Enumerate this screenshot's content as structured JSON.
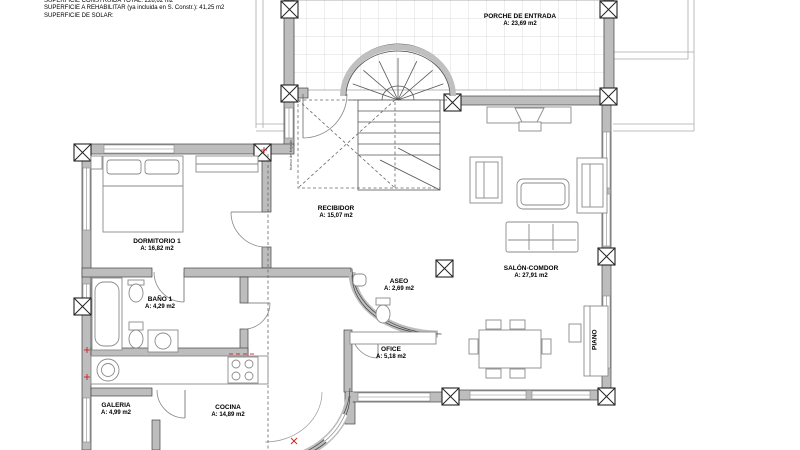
{
  "header": {
    "line1": "SUPERFICIE CONSTRUIDA TOTAL: 228,62 m2",
    "line2": "SUPERFICIE A REHABILITAR (ya incluida en S. Constr.): 41,25 m2",
    "line3": "SUPERFICIE DE SOLAR:"
  },
  "rooms": [
    {
      "id": "porche",
      "name": "PORCHE DE ENTRADA",
      "area": "A: 23,69 m2"
    },
    {
      "id": "recibidor",
      "name": "RECIBIDOR",
      "area": "A: 15,07 m2"
    },
    {
      "id": "dormitorio1",
      "name": "DORMITORIO 1",
      "area": "A: 16,82 m2"
    },
    {
      "id": "bano1",
      "name": "BAÑO 1",
      "area": "A: 4,29 m2"
    },
    {
      "id": "aseo",
      "name": "ASEO",
      "area": "A: 2,69 m2"
    },
    {
      "id": "salon",
      "name": "SALÓN-COMDOR",
      "area": "A: 27,91 m2"
    },
    {
      "id": "ofice",
      "name": "OFICE",
      "area": "A: 5,18 m2"
    },
    {
      "id": "galeria",
      "name": "GALERIA",
      "area": "A: 4,99 m2"
    },
    {
      "id": "cocina",
      "name": "COCINA",
      "area": "A: 14,89 m2"
    }
  ],
  "labels": {
    "piano": "PIANO",
    "stair_void": "hueco de forjado"
  },
  "colors": {
    "wall_fill": "#bdbdbd",
    "wall_edge": "#444444",
    "furniture_line": "#8a8a8a",
    "tile_line": "#d0d0d0",
    "accent_red": "#cc2222"
  }
}
